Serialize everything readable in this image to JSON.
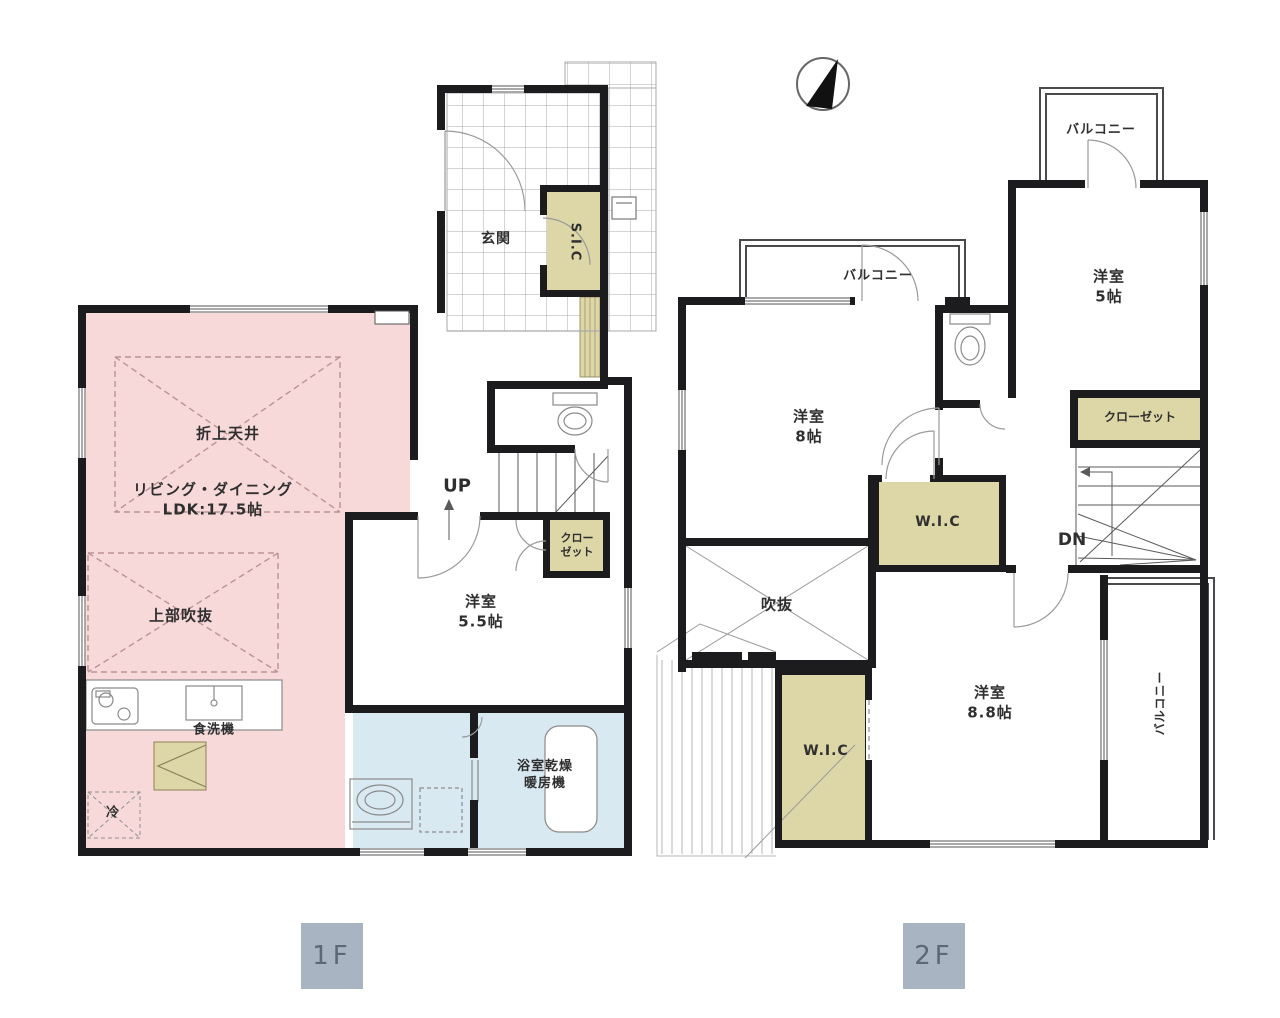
{
  "compass": {
    "name": "north-arrow"
  },
  "floor1": {
    "badge": "1F",
    "labels": {
      "genkan": "玄関",
      "sic": "S.I.C",
      "oriage_tenjo": "折上天井",
      "living_dining": "リビング・ダイニング\nLDK:17.5帖",
      "joubu_fukinuke": "上部吹抜",
      "up": "UP",
      "closet": "クロー\nゼット",
      "yoshitsu_55": "洋室\n5.5帖",
      "shokusenki": "食洗機",
      "rei": "冷",
      "yokushitsu_kansou": "浴室乾燥\n暖房機"
    }
  },
  "floor2": {
    "badge": "2F",
    "labels": {
      "balcony_left": "バルコニー",
      "balcony_right_top": "バルコニー",
      "balcony_side": "バルコニー",
      "yoshitsu_8": "洋室\n8帖",
      "yoshitsu_5": "洋室\n5帖",
      "closet": "クローゼット",
      "dn": "DN",
      "wic_upper": "W.I.C",
      "wic_lower": "W.I.C",
      "fukinuke": "吹抜",
      "yoshitsu_88": "洋室\n8.8帖"
    }
  },
  "colors": {
    "wall": "#1c1c1e",
    "ldk_pink": "#f8d9da",
    "closet_beige": "#ddd6a6",
    "bath_blue": "#d9e9f2",
    "ceiling_dash": "#bb9296",
    "badge_bg": "#a9b4c3",
    "badge_text": "#5d6875",
    "label_text": "#2f2f2f"
  }
}
